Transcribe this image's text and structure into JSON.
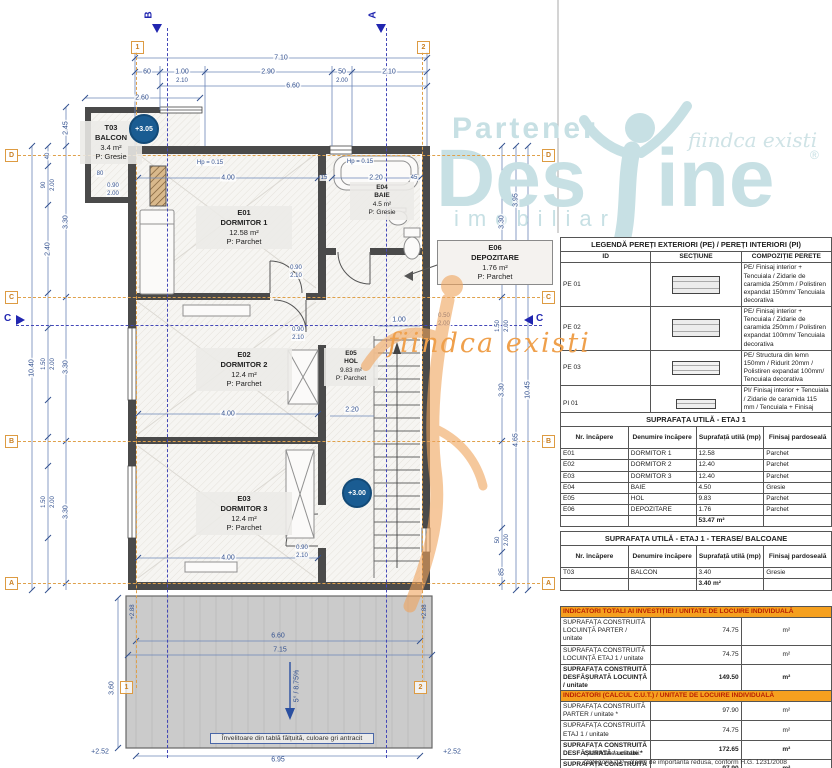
{
  "watermark": {
    "partener": "Partener",
    "brand_left": "Des",
    "brand_right": "ine",
    "tagline": "fiindca existi",
    "registered": "®",
    "imobiliare": "imobiliare",
    "script": "fiindca existi"
  },
  "colors": {
    "dim_blue": "#33518f",
    "grid_orange": "#dd9b42",
    "indicator_header_bg": "#f5a01f",
    "indicator_header_text": "#b81f00",
    "watermark_teal": "#c7e0e4",
    "watermark_orange": "#efa04c",
    "level_badge_blue": "#1a5c92"
  },
  "plan": {
    "rooms": [
      {
        "id": "T03",
        "name": "BALCON",
        "area": "3.4 m²",
        "finish": "P: Gresie"
      },
      {
        "id": "E01",
        "name": "DORMITOR 1",
        "area": "12.58 m²",
        "finish": "P: Parchet"
      },
      {
        "id": "E04",
        "name": "BAIE",
        "area": "4.5 m²",
        "finish": "P: Gresie"
      },
      {
        "id": "E06",
        "name": "DEPOZITARE",
        "area": "1.76 m²",
        "finish": "P: Parchet"
      },
      {
        "id": "E02",
        "name": "DORMITOR 2",
        "area": "12.4 m²",
        "finish": "P: Parchet"
      },
      {
        "id": "E05",
        "name": "HOL",
        "area": "9.83 m²",
        "finish": "P: Parchet"
      },
      {
        "id": "E03",
        "name": "DORMITOR 3",
        "area": "12.4 m²",
        "finish": "P: Parchet"
      }
    ],
    "levels": {
      "balcony": "+3.05",
      "floor": "+3.00"
    },
    "grid": {
      "cols": [
        "1",
        "2"
      ],
      "rows": [
        "D",
        "C",
        "B",
        "A"
      ]
    },
    "sections": {
      "b": "B",
      "a": "A",
      "c": "C"
    },
    "roof": {
      "note": "Învelitoare din tablă fălțuită, culoare gri antracit"
    },
    "dims": [
      "7.10",
      "60",
      "1.00",
      "2.10",
      "2.90",
      "50",
      "2.00",
      "2.10",
      "6.60",
      "2.60",
      "2.45",
      "40",
      "90",
      "2.00",
      "2.40",
      "3.30",
      "1.50",
      "2.00",
      "3.30",
      "10.40",
      "1.50",
      "2.00",
      "3.30",
      "3.30",
      "3.95",
      "1.50",
      "2.00",
      "3.30",
      "10.45",
      "4.65",
      "50",
      "2.00",
      "85",
      "4.00",
      "15",
      "2.20",
      "45",
      "0.90",
      "2.10",
      "4.00",
      "0.90",
      "2.10",
      "1.00",
      "0.50",
      "2.00",
      "2.20",
      "4.00",
      "0.90",
      "2.10",
      "0.90",
      "2.00",
      "Hp = 0.15",
      "Hp = 0.15",
      "6.60",
      "7.15",
      "6.95",
      "5° / 8.75%",
      "+2.52",
      "+2.52",
      "+2.88",
      "+2.88",
      "3.60",
      "80"
    ]
  },
  "legend": {
    "title": "LEGENDĂ PEREȚI EXTERIORI (PE) / PEREȚI INTERIORI (PI)",
    "headers": [
      "ID",
      "SECȚIUNE",
      "COMPOZIȚIE PERETE"
    ],
    "rows": [
      {
        "id": "PE 01",
        "desc": "PE/ Finisaj interior + Tencuiala / Zidarie de caramida 250mm / Polistiren expandat 150mm/ Tencuiala decorativa"
      },
      {
        "id": "PE 02",
        "desc": "PE/ Finisaj interior + Tencuiala / Zidarie de caramida 250mm / Polistiren expandat 100mm/ Tencuiala decorativa"
      },
      {
        "id": "PE 03",
        "desc": "PE/ Structura din lemn 150mm / Ridurit 20mm / Polistiren expandat 100mm/ Tencuiala decorativa"
      },
      {
        "id": "PI 01",
        "desc": "PI/ Finisaj interior + Tencuiala / Zidarie de caramida 115 mm / Tencuiala + Finisaj interior"
      },
      {
        "id": "PI 02",
        "desc": "Placaj gips-carton"
      }
    ]
  },
  "etaj": {
    "title": "SUPRAFAȚA UTILĂ - ETAJ 1",
    "headers": [
      "Nr. încăpere",
      "Denumire încăpere",
      "Suprafață utilă (mp)",
      "Finisaj pardoseală"
    ],
    "rows": [
      {
        "nr": "E01",
        "name": "DORMITOR 1",
        "area": "12.58",
        "finish": "Parchet"
      },
      {
        "nr": "E02",
        "name": "DORMITOR 2",
        "area": "12.40",
        "finish": "Parchet"
      },
      {
        "nr": "E03",
        "name": "DORMITOR 3",
        "area": "12.40",
        "finish": "Parchet"
      },
      {
        "nr": "E04",
        "name": "BAIE",
        "area": "4.50",
        "finish": "Gresie"
      },
      {
        "nr": "E05",
        "name": "HOL",
        "area": "9.83",
        "finish": "Parchet"
      },
      {
        "nr": "E06",
        "name": "DEPOZITARE",
        "area": "1.76",
        "finish": "Parchet"
      }
    ],
    "total": "53.47 m²"
  },
  "balc": {
    "title": "SUPRAFAȚA UTILĂ - ETAJ 1 - TERASE/ BALCOANE",
    "rows": [
      {
        "nr": "T03",
        "name": "BALCON",
        "area": "3.40",
        "finish": "Gresie"
      }
    ],
    "total": "3.40 m²"
  },
  "ind_total": {
    "title": "INDICATORI TOTALI AI INVESTIȚIEI / UNITATE DE LOCUIRE INDIVIDUALĂ",
    "unit": "m²",
    "rows": [
      {
        "label": "SUPRAFAȚA CONSTRUITĂ LOCUINȚĂ PARTER / unitate",
        "value": "74.75"
      },
      {
        "label": "SUPRAFAȚA CONSTRUITĂ LOCUINȚĂ ETAJ 1 / unitate",
        "value": "74.75"
      },
      {
        "label": "SUPRAFAȚA CONSTRUITĂ DESFĂȘURATĂ LOCUINȚĂ / unitate",
        "value": "149.50"
      },
      {
        "label": "SUPRAFAȚA CONSTRUITĂ LOCUINȚĂ/ unitate",
        "value": "74.75"
      },
      {
        "label": "SUPRAFAȚA CONSTRUITĂ TERASĂ",
        "value": "19.75"
      },
      {
        "label": "SUPRAFAȚA CONSTRUITĂ BALCON",
        "value": "3.40"
      }
    ]
  },
  "ind_cut": {
    "title": "INDICATORI (CALCUL C.U.T.) / UNITATE DE LOCUIRE INDIVIDUALĂ",
    "unit": "m²",
    "rows": [
      {
        "label": "SUPRAFAȚA CONSTRUITĂ PARTER / unitate *",
        "value": "97.90"
      },
      {
        "label": "SUPRAFAȚA CONSTRUITĂ ETAJ 1 / unitate",
        "value": "74.75"
      },
      {
        "label": "SUPRAFAȚA CONSTRUITĂ DESFĂȘURATĂ / unitate *",
        "value": "172.65"
      },
      {
        "label": "SUPRAFAȚA CONSTRUITĂ / unitate *",
        "value": "97.90"
      }
    ]
  },
  "footnote": {
    "lines": [
      "Clasificarea cladirii:",
      "Categoria \"D\" - cladiri de importanta redusa, conform H.G. 1231/2008",
      "Clasa de importanta III-E, conform P100-1/2013"
    ]
  }
}
